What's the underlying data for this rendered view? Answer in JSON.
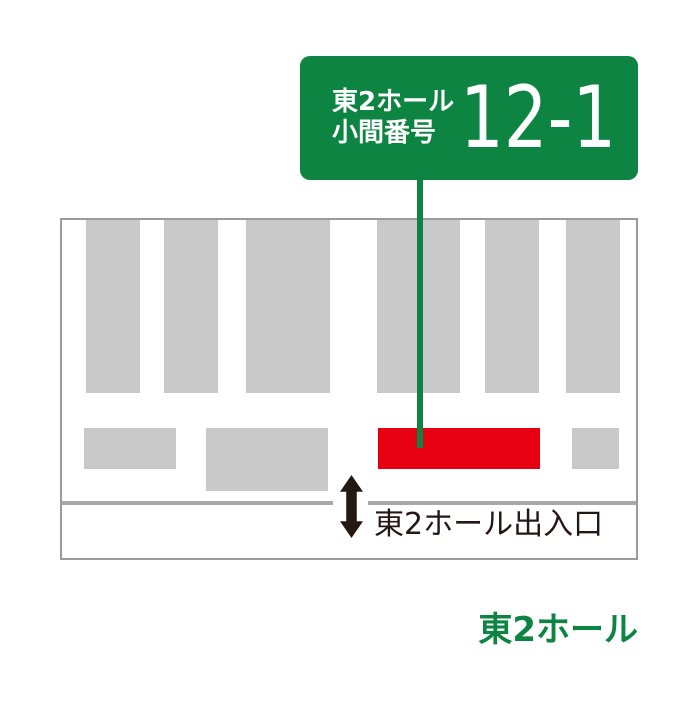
{
  "callout": {
    "hall_label": "東2ホール",
    "booth_type_label": "小間番号",
    "booth_number": "12-1"
  },
  "floor_plan": {
    "entrance_label": "東2ホール出入口",
    "top_booth_y": 0,
    "top_booth_h": 173,
    "top_booths": [
      {
        "x": 24,
        "w": 54
      },
      {
        "x": 102,
        "w": 54
      },
      {
        "x": 184,
        "w": 84
      },
      {
        "x": 315,
        "w": 83
      },
      {
        "x": 423,
        "w": 54
      },
      {
        "x": 504,
        "w": 54
      }
    ],
    "bottom_booth_y": 208,
    "bottom_booths": [
      {
        "x": 22,
        "w": 92,
        "h": 41,
        "highlighted": false
      },
      {
        "x": 144,
        "w": 122,
        "h": 63,
        "highlighted": false
      },
      {
        "x": 316,
        "w": 162,
        "h": 41,
        "highlighted": true
      },
      {
        "x": 510,
        "w": 47,
        "h": 41,
        "highlighted": false
      }
    ]
  },
  "footer": {
    "hall_name": "東2ホール"
  },
  "colors": {
    "green": "#0e8442",
    "booth_gray": "#c9c9c9",
    "highlight_red": "#e60012",
    "border_gray": "#9b9b9b",
    "wall_gray": "#a9a9a9",
    "ink_black": "#231815"
  }
}
